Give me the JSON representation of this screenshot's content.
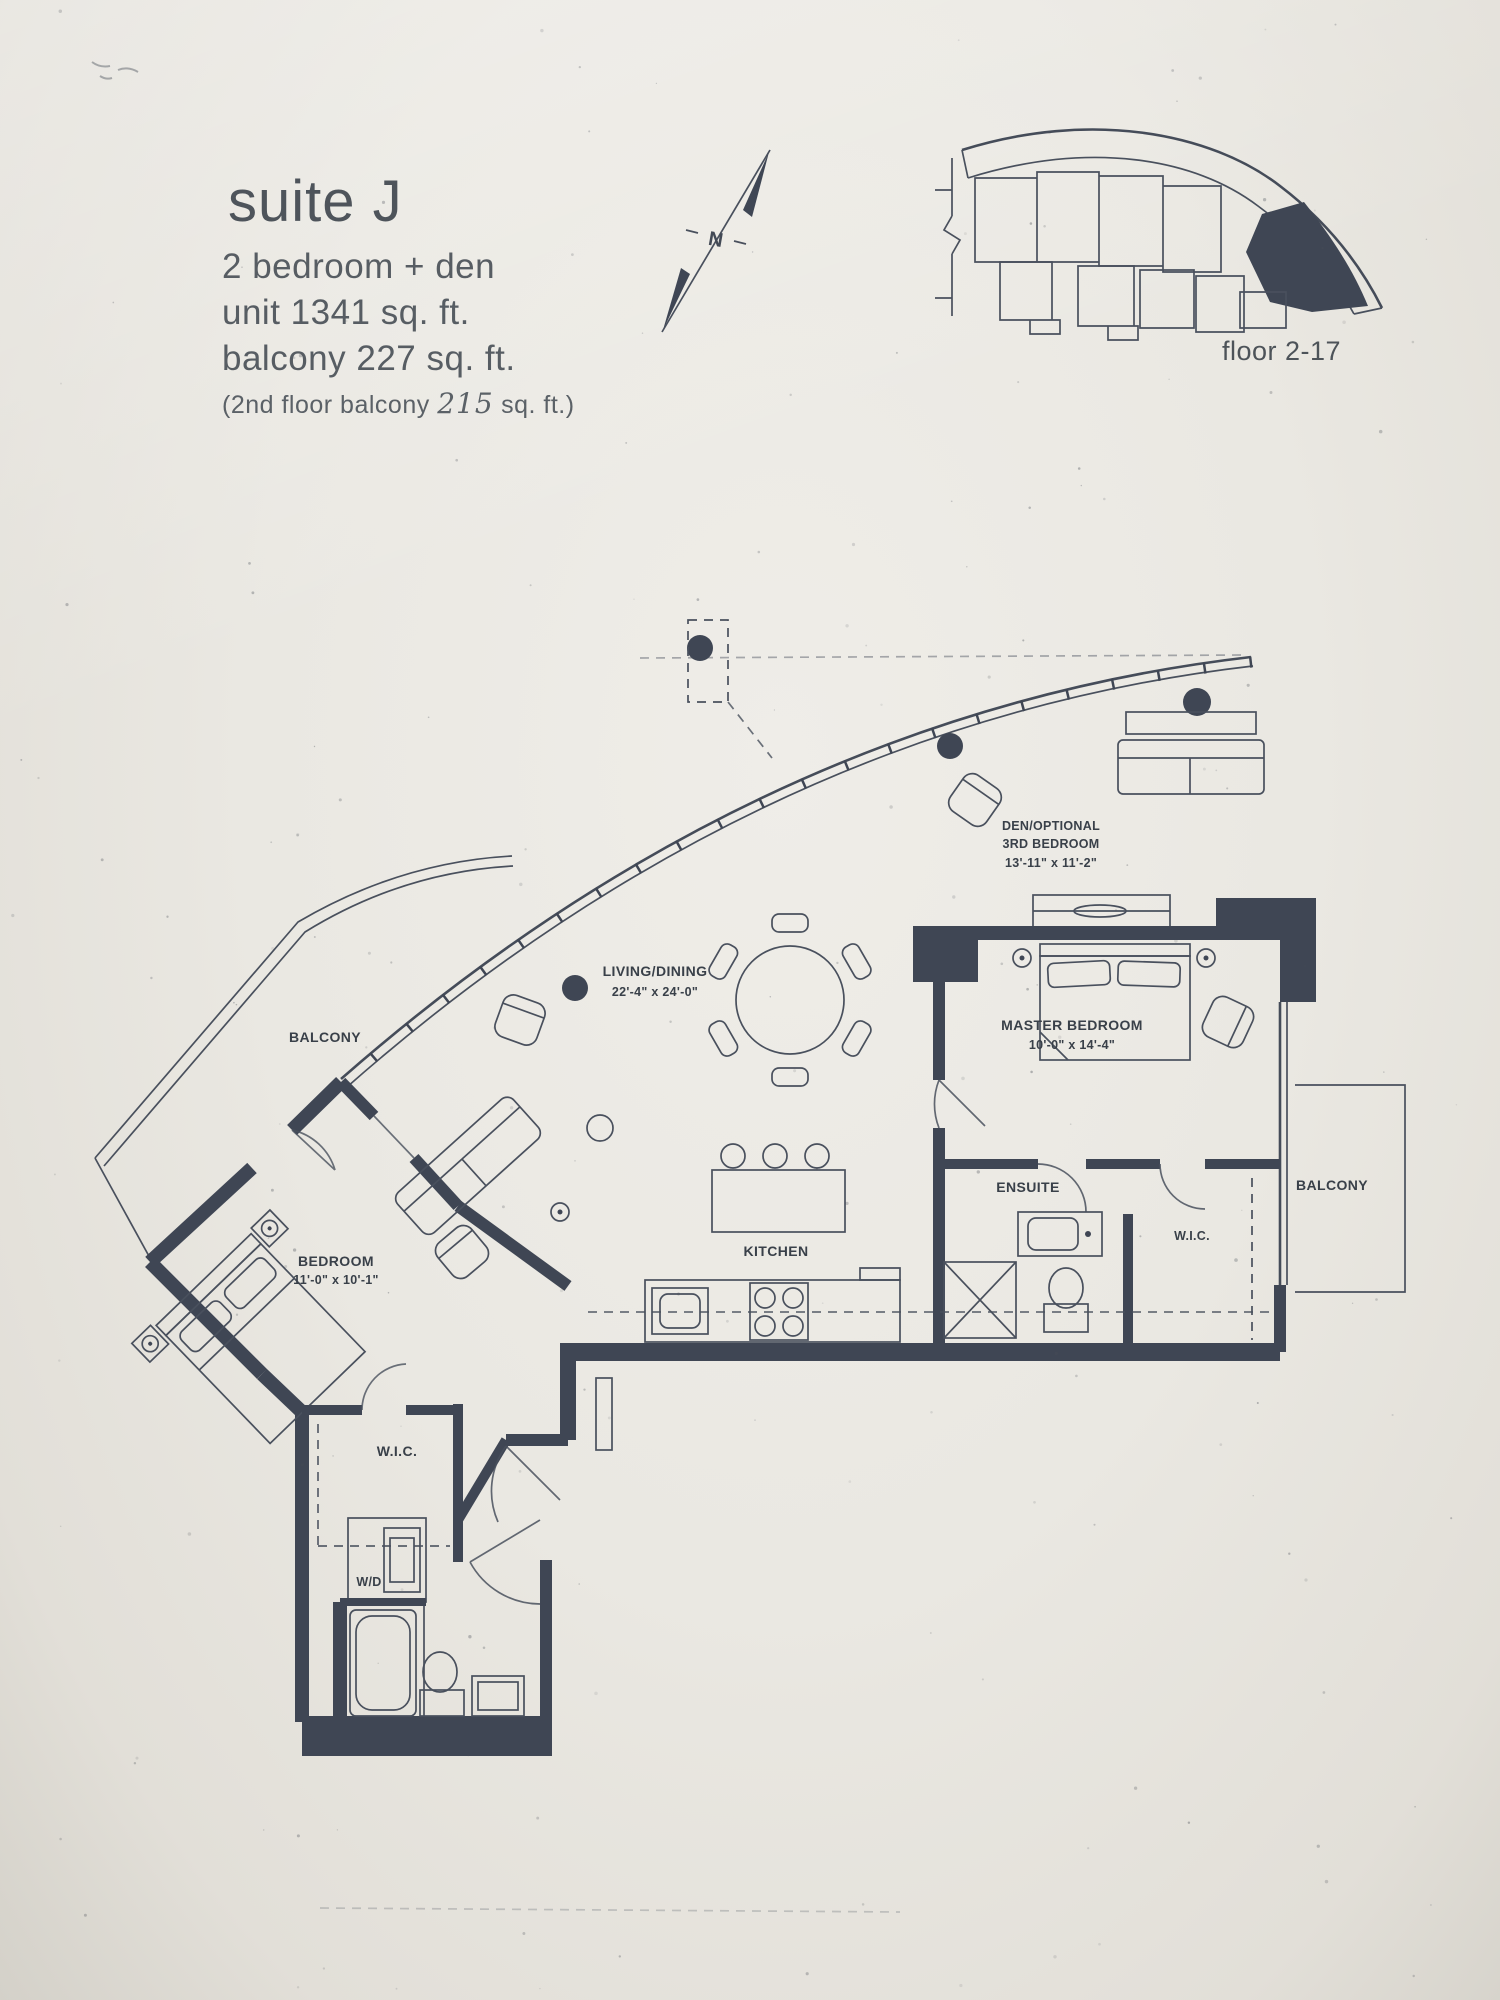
{
  "colors": {
    "paper": "#eae8e2",
    "ink": "#3f4654",
    "header_text": "#575d63"
  },
  "header": {
    "suite_title": "suite J",
    "suite_type": "2 bedroom + den",
    "unit_area": "unit 1341 sq. ft.",
    "balcony_area": "balcony 227 sq. ft.",
    "note_prefix": "(2nd floor balcony ",
    "note_value": "215",
    "note_suffix": " sq. ft.)"
  },
  "keyplan": {
    "caption": "floor 2-17",
    "north_label": "N"
  },
  "rooms": {
    "balcony_left": "BALCONY",
    "balcony_right": "BALCONY",
    "bedroom": {
      "name": "BEDROOM",
      "dims": "11'-0\" x 10'-1\""
    },
    "living_dining": {
      "name": "LIVING/DINING",
      "dims": "22'-4\" x 24'-0\""
    },
    "den": {
      "line1": "DEN/OPTIONAL",
      "line2": "3RD BEDROOM",
      "dims": "13'-11\" x 11'-2\""
    },
    "master_bedroom": {
      "name": "MASTER BEDROOM",
      "dims": "10'-0\" x 14'-4\""
    },
    "ensuite": "ENSUITE",
    "wic_master": "W.I.C.",
    "wic_bedroom": "W.I.C.",
    "kitchen": "KITCHEN",
    "washer_dryer": "W/D"
  }
}
